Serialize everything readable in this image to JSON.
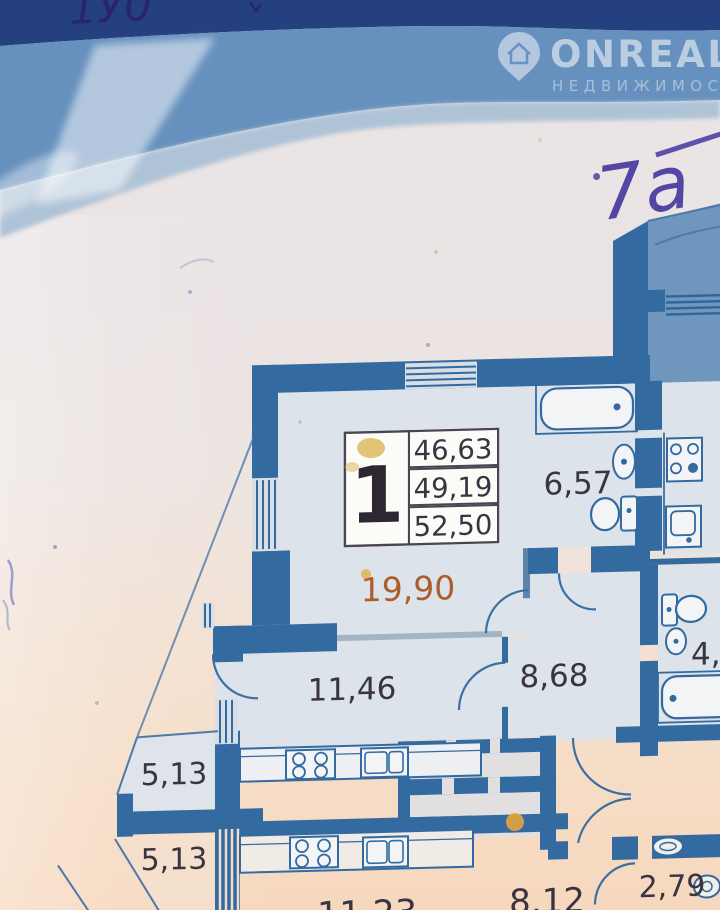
{
  "banner": {
    "brand": "ONREALT",
    "brand_subtitle": "НЕДВИЖИМОСТЬ",
    "handwriting_top": "1У0",
    "handwriting_note": "7а"
  },
  "unit_table": {
    "unit_number": "1",
    "rows": [
      "46,63",
      "49,19",
      "52,50"
    ]
  },
  "room_labels": {
    "living": "19,90",
    "bathroom_top": "6,57",
    "kitchen": "11,46",
    "hallway": "8,68",
    "bathroom_right": "4,9",
    "balcony_upper": "5,13",
    "balcony_lower": "5,13",
    "neighbor_room_left": "11,23",
    "neighbor_room_center": "8,12",
    "neighbor_room_right": "2,79"
  },
  "icons": {
    "logo_pin": "map-pin-with-house",
    "bathtub": "bathtub-outline",
    "toilet": "toilet-outline",
    "sink": "sink-oval",
    "stove": "four-burner-stove"
  },
  "colors": {
    "wall": "#336aa0",
    "balcony_fill": "#6f96bd",
    "room_fill": "#dde3ea",
    "banner_navy": "#25407f",
    "banner_blue": "#6690bd",
    "banner_light": "#a9c0d6",
    "area_living_accent": "#ad5c2b",
    "ink": "#43369e",
    "stain_yellow": "#d9b14b"
  }
}
